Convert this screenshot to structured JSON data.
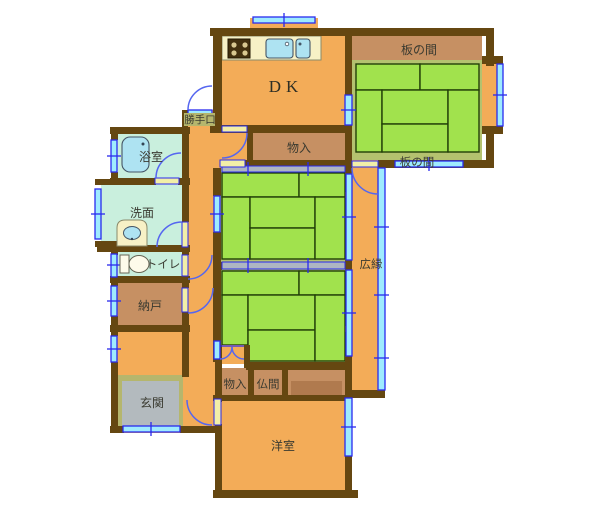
{
  "figure": {
    "type": "floor-plan",
    "style": "japanese-residential-single-floor"
  },
  "rooms": {
    "dk": {
      "label": "DK"
    },
    "itanoma_top": {
      "label": "板の間"
    },
    "itanoma_lower": {
      "label": "板の間"
    },
    "monoire_top": {
      "label": "物入"
    },
    "katteguchi": {
      "label": "勝手口"
    },
    "bathroom": {
      "label": "浴室"
    },
    "washroom": {
      "label": "洗面"
    },
    "toilet": {
      "label": "トイレ"
    },
    "nando": {
      "label": "納戸"
    },
    "genkan": {
      "label": "玄関"
    },
    "monoire_lower": {
      "label": "物入"
    },
    "butsuma": {
      "label": "仏間"
    },
    "hiroen": {
      "label": "広縁"
    },
    "yoshitsu": {
      "label": "洋室"
    }
  },
  "fixtures": {
    "kitchen": [
      "stove-icon",
      "kitchen-sink-icon",
      "kitchen-sink-icon"
    ],
    "bathroom": [
      "bathtub-icon"
    ],
    "washroom": [
      "washbasin-icon"
    ],
    "toilet": [
      "toilet-icon"
    ]
  },
  "palette": {
    "floor_orange": "#F3AC58",
    "tatami_green": "#A1E24D",
    "tatami_border_olive": "#B4C26F",
    "wood_tan": "#C69063",
    "wall_brown": "#654711",
    "wet_room_mint": "#C9EFDD",
    "window_blue": "#2A2AEE",
    "window_cyan": "#9FEBFE",
    "door_arc_blue": "#5566F0",
    "fixture_cream": "#F7F1C6",
    "fixture_blue": "#AEE3F2",
    "genkan_gray": "#B3BABE",
    "genkan_khaki": "#B5B66D",
    "sliding_gray": "#AEB6C2"
  }
}
